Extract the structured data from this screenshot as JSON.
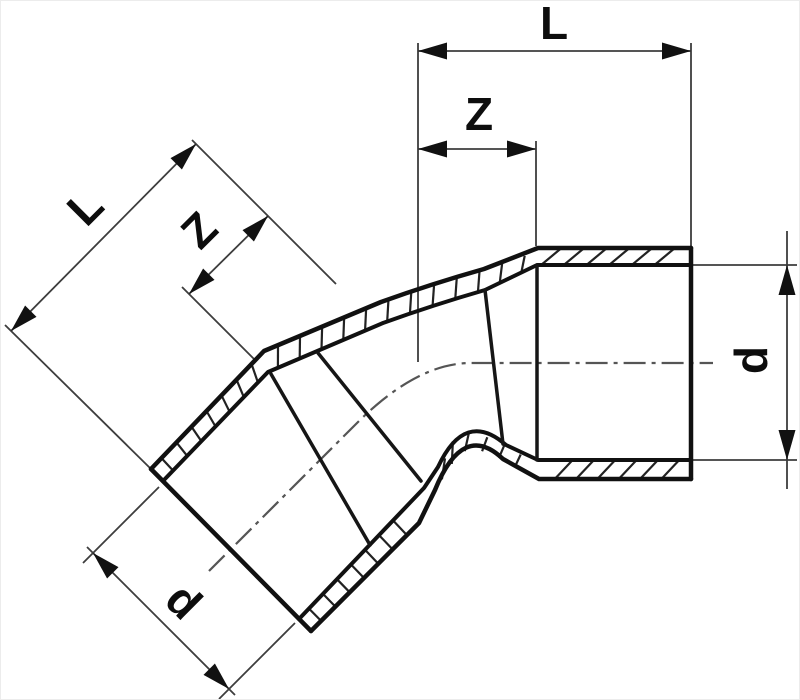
{
  "figure": {
    "description": "Sectional technical drawing of a 45-degree elbow pipe fitting with two socket ends",
    "labels": {
      "top_length": "L",
      "top_socket_depth": "Z",
      "right_diameter": "d",
      "left_length": "L",
      "left_socket_depth": "Z",
      "left_diameter": "d"
    },
    "colors": {
      "outline": "#111111",
      "dimension_lines": "#3d3d3d",
      "centerline": "#555555",
      "background": "#ffffff"
    }
  }
}
